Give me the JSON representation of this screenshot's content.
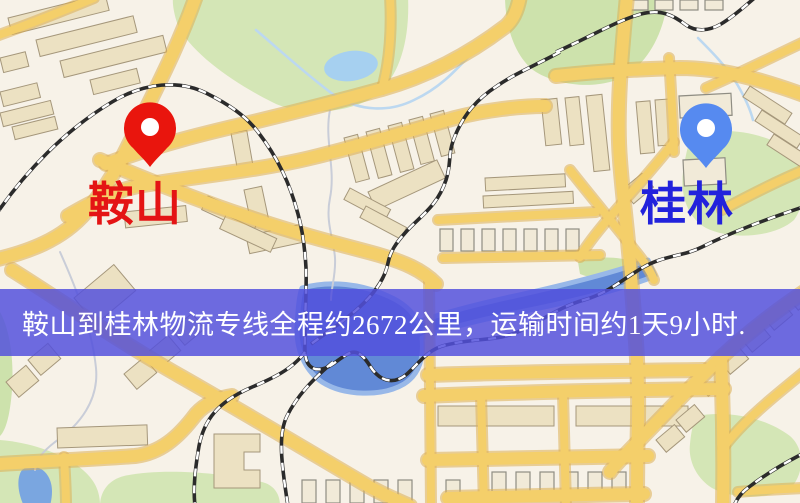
{
  "markers": {
    "origin": {
      "label": "鞍山",
      "pin_color": "#e9150d",
      "label_color": "#e41414"
    },
    "destination": {
      "label": "桂林",
      "pin_color": "#568af0",
      "label_color": "#2222dc"
    }
  },
  "banner": {
    "text": "鞍山到桂林物流专线全程约2672公里，运输时间约1天9小时.",
    "background_color": "#5250dc",
    "text_color": "#ffffff"
  },
  "map_colors": {
    "land": "#f7f2e8",
    "road": "#f4cf6a",
    "park": "#d4e6b6",
    "water_river": "#6189d6",
    "water_lake": "#a6d0f0",
    "railway": "#2b2b2b",
    "building": "#ece1c2"
  }
}
